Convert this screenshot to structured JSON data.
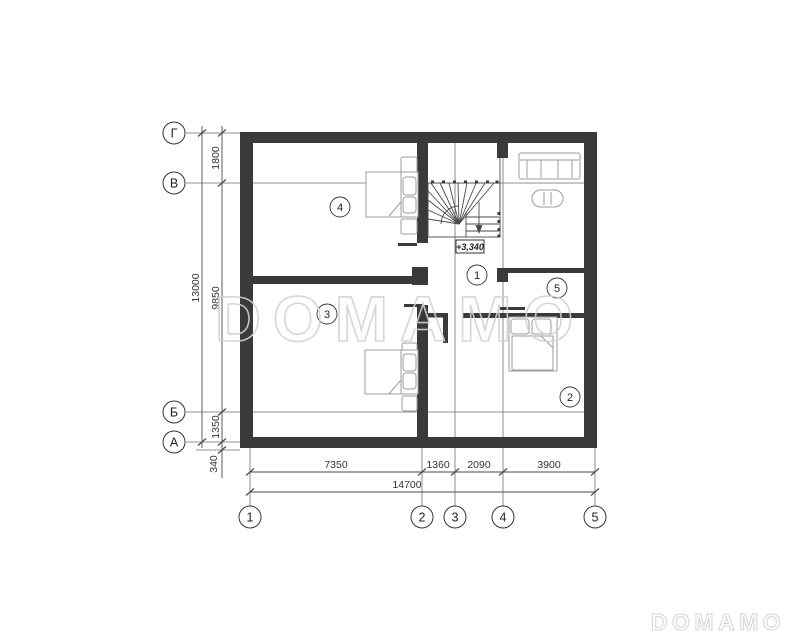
{
  "watermarks": {
    "center_text": "DOMAMO",
    "corner_text": "DOMAMO"
  },
  "plan": {
    "elevation_mark": "+3,340",
    "room_labels": [
      {
        "number": "4"
      },
      {
        "number": "3"
      },
      {
        "number": "1"
      },
      {
        "number": "5"
      },
      {
        "number": "2"
      }
    ]
  },
  "axes": {
    "left": [
      {
        "label": "Г"
      },
      {
        "label": "В"
      },
      {
        "label": "Б"
      },
      {
        "label": "А"
      }
    ],
    "bottom": [
      {
        "label": "1"
      },
      {
        "label": "2"
      },
      {
        "label": "3"
      },
      {
        "label": "4"
      },
      {
        "label": "5"
      }
    ]
  },
  "dimensions": {
    "left_total": "13000",
    "left_segments": [
      "1800",
      "9850",
      "1350",
      "340"
    ],
    "bottom_segments": [
      "7350",
      "1360",
      "2090",
      "3900"
    ],
    "bottom_total": "14700"
  },
  "colors": {
    "wall": "#3a3a3a",
    "thin_line": "#6e6e6e",
    "dim_line": "#4a4a4a",
    "furniture": "#9c9c9c",
    "watermark": "#d2d2d2",
    "text": "#333333"
  }
}
